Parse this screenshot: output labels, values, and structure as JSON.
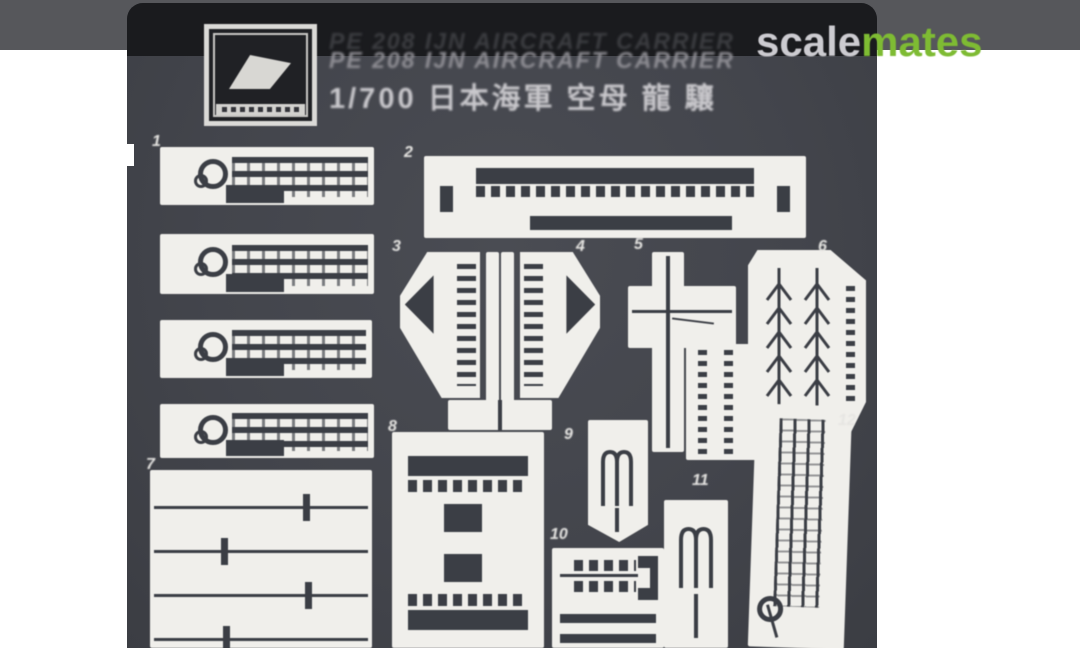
{
  "plate": {
    "title_en": "PE 208 IJN AIRCRAFT CARRIER",
    "title_jp": "1/700 日本海軍 空母 龍 驤"
  },
  "watermark": {
    "part_gray": "scale",
    "part_green": "mates"
  },
  "parts": {
    "labels": [
      "1",
      "2",
      "3",
      "4",
      "5",
      "6",
      "7",
      "8",
      "9",
      "10",
      "11",
      "12"
    ]
  },
  "colors": {
    "top_band": "#56575B",
    "fret_body": "#43454C",
    "fret_header": "#1A1B1E",
    "etched_metal": "#F0EFEB",
    "etch_detail": "#3B3E45",
    "watermark_gray": "#CCCBD0",
    "watermark_green": "#7EBB33"
  }
}
